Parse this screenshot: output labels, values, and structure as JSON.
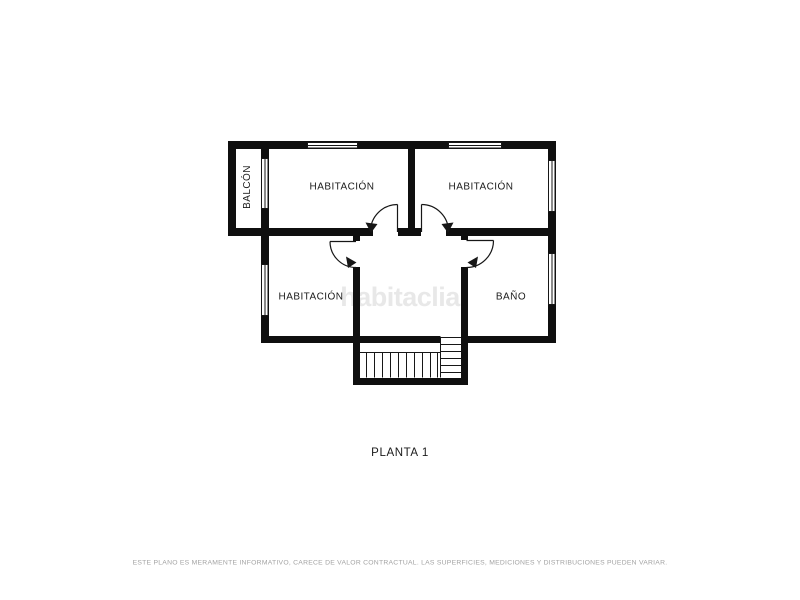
{
  "floor_plan": {
    "floor_title": "PLANTA 1",
    "watermark": "habitaclia",
    "disclaimer": "ESTE PLANO ES MERAMENTE INFORMATIVO, CARECE DE VALOR CONTRACTUAL. LAS SUPERFICIES, MEDICIONES Y DISTRIBUCIONES PUEDEN VARIAR.",
    "rooms": {
      "balcony": "BALCÓN",
      "bedroom_top_left": "HABITACIÓN",
      "bedroom_top_right": "HABITACIÓN",
      "bedroom_mid_left": "HABITACIÓN",
      "bathroom": "BAÑO"
    },
    "colors": {
      "walls": "#0f0f0f",
      "background": "#ffffff",
      "watermark_text": "#e8e8e8",
      "disclaimer_text": "#a3a3a3"
    }
  }
}
